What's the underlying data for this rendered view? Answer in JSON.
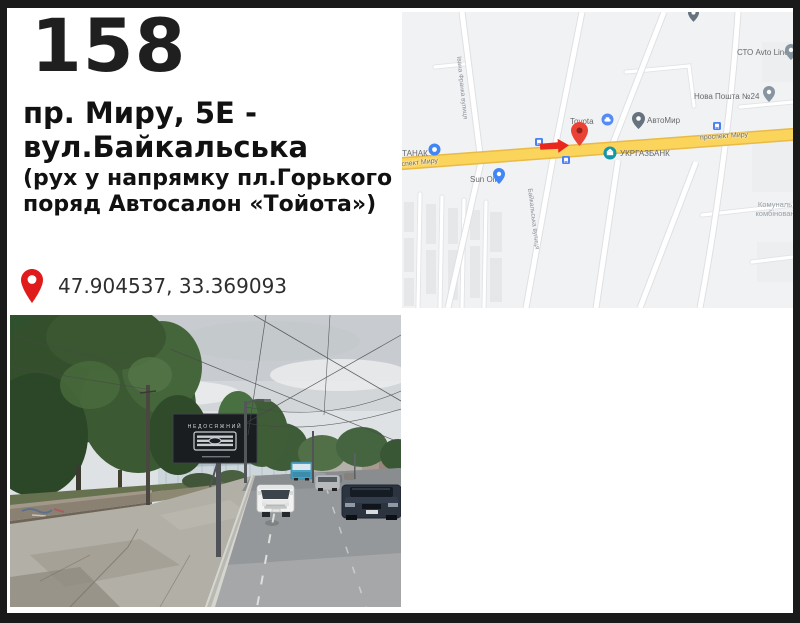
{
  "card": {
    "number": "158",
    "address_line1": "пр. Миру, 5Е -",
    "address_line2": "вул.Байкальська",
    "note_line1": "(рух у напрямку пл.Горького",
    "note_line2": "поряд Автосалон «Тойота»)",
    "coordinates": "47.904537, 33.369093"
  },
  "map": {
    "streets": {
      "prospekt": "проспект Миру",
      "baikalska": "Байкальська вулиця",
      "franka": "Івана Франка вулиця"
    },
    "poi": {
      "tanak": "ТАНАК",
      "sun_oil": "Sun Oil",
      "toyota": "Toyota",
      "avtomir": "АвтоМир",
      "ukrgasbank": "УКРГАЗБАНК",
      "nova_poshta": "Нова Пошта №24",
      "sto_avto_line": "СТО Avto Line",
      "komunal_line1": "Комуналь",
      "komunal_line2": "комбінован"
    },
    "colors": {
      "main_road_yellow": "#fbd45c",
      "marker_red": "#ea4335",
      "arrow_red": "#e8281c",
      "transit_blue": "#4a80f2",
      "map_background": "#f1f2f4"
    }
  },
  "photo": {
    "billboard_text": "НЕДОСЯЖНИЙ"
  }
}
